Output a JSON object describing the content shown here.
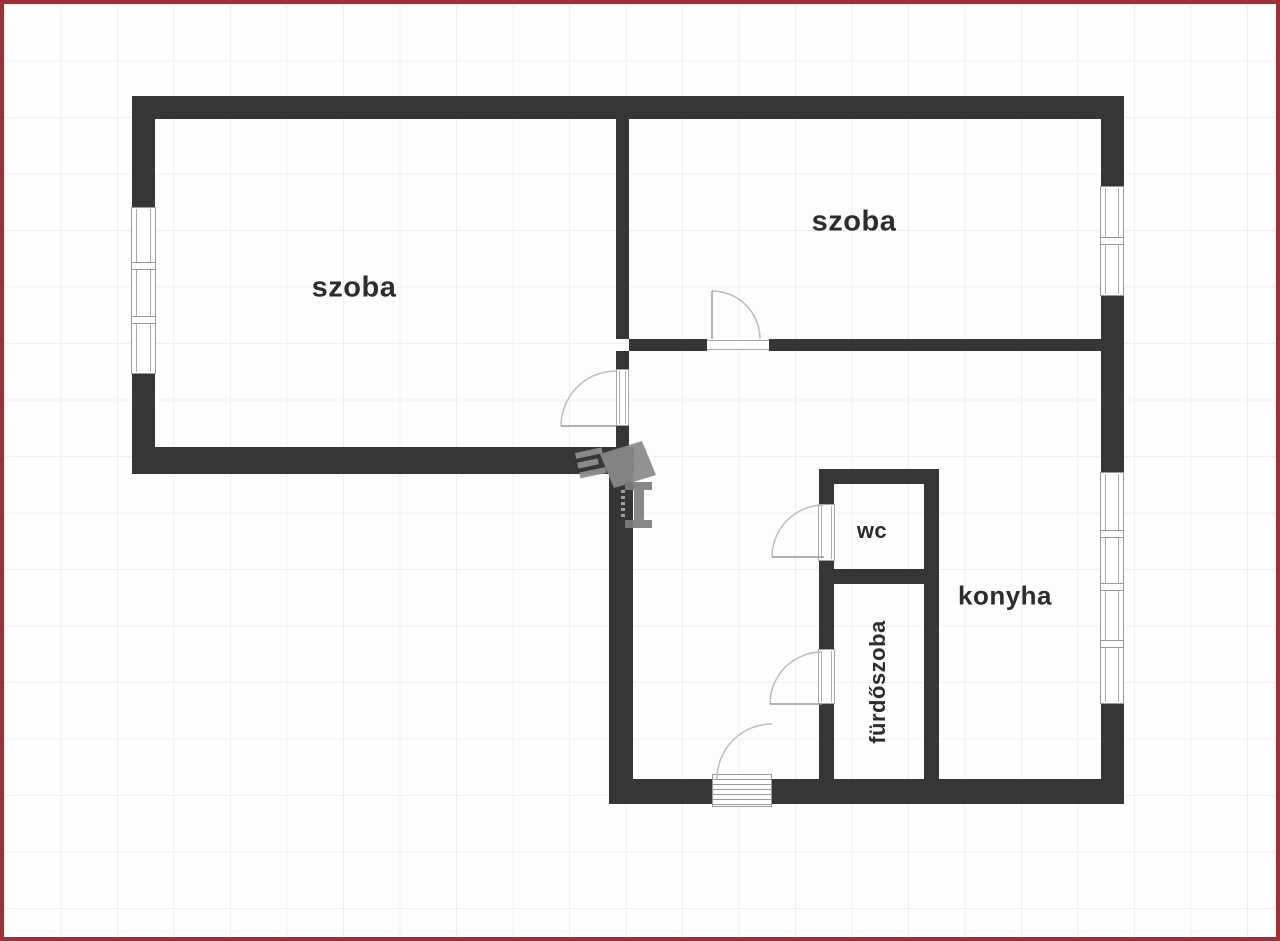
{
  "diagram_type": "apartment-floor-plan",
  "rooms": {
    "szoba_left": "szoba",
    "szoba_right": "szoba",
    "wc": "wc",
    "konyha": "konyha",
    "furdoszoba": "fürdőszoba"
  },
  "colors": {
    "frame_border": "#9e3034",
    "wall": "#363636",
    "grid_line": "#f2eeee",
    "background": "#fdfdfd",
    "label_text": "#2d2d2d",
    "window_stroke": "#9a9a9a",
    "door_arc": "#bdbdbd",
    "watermark": "#8a8a8a"
  }
}
